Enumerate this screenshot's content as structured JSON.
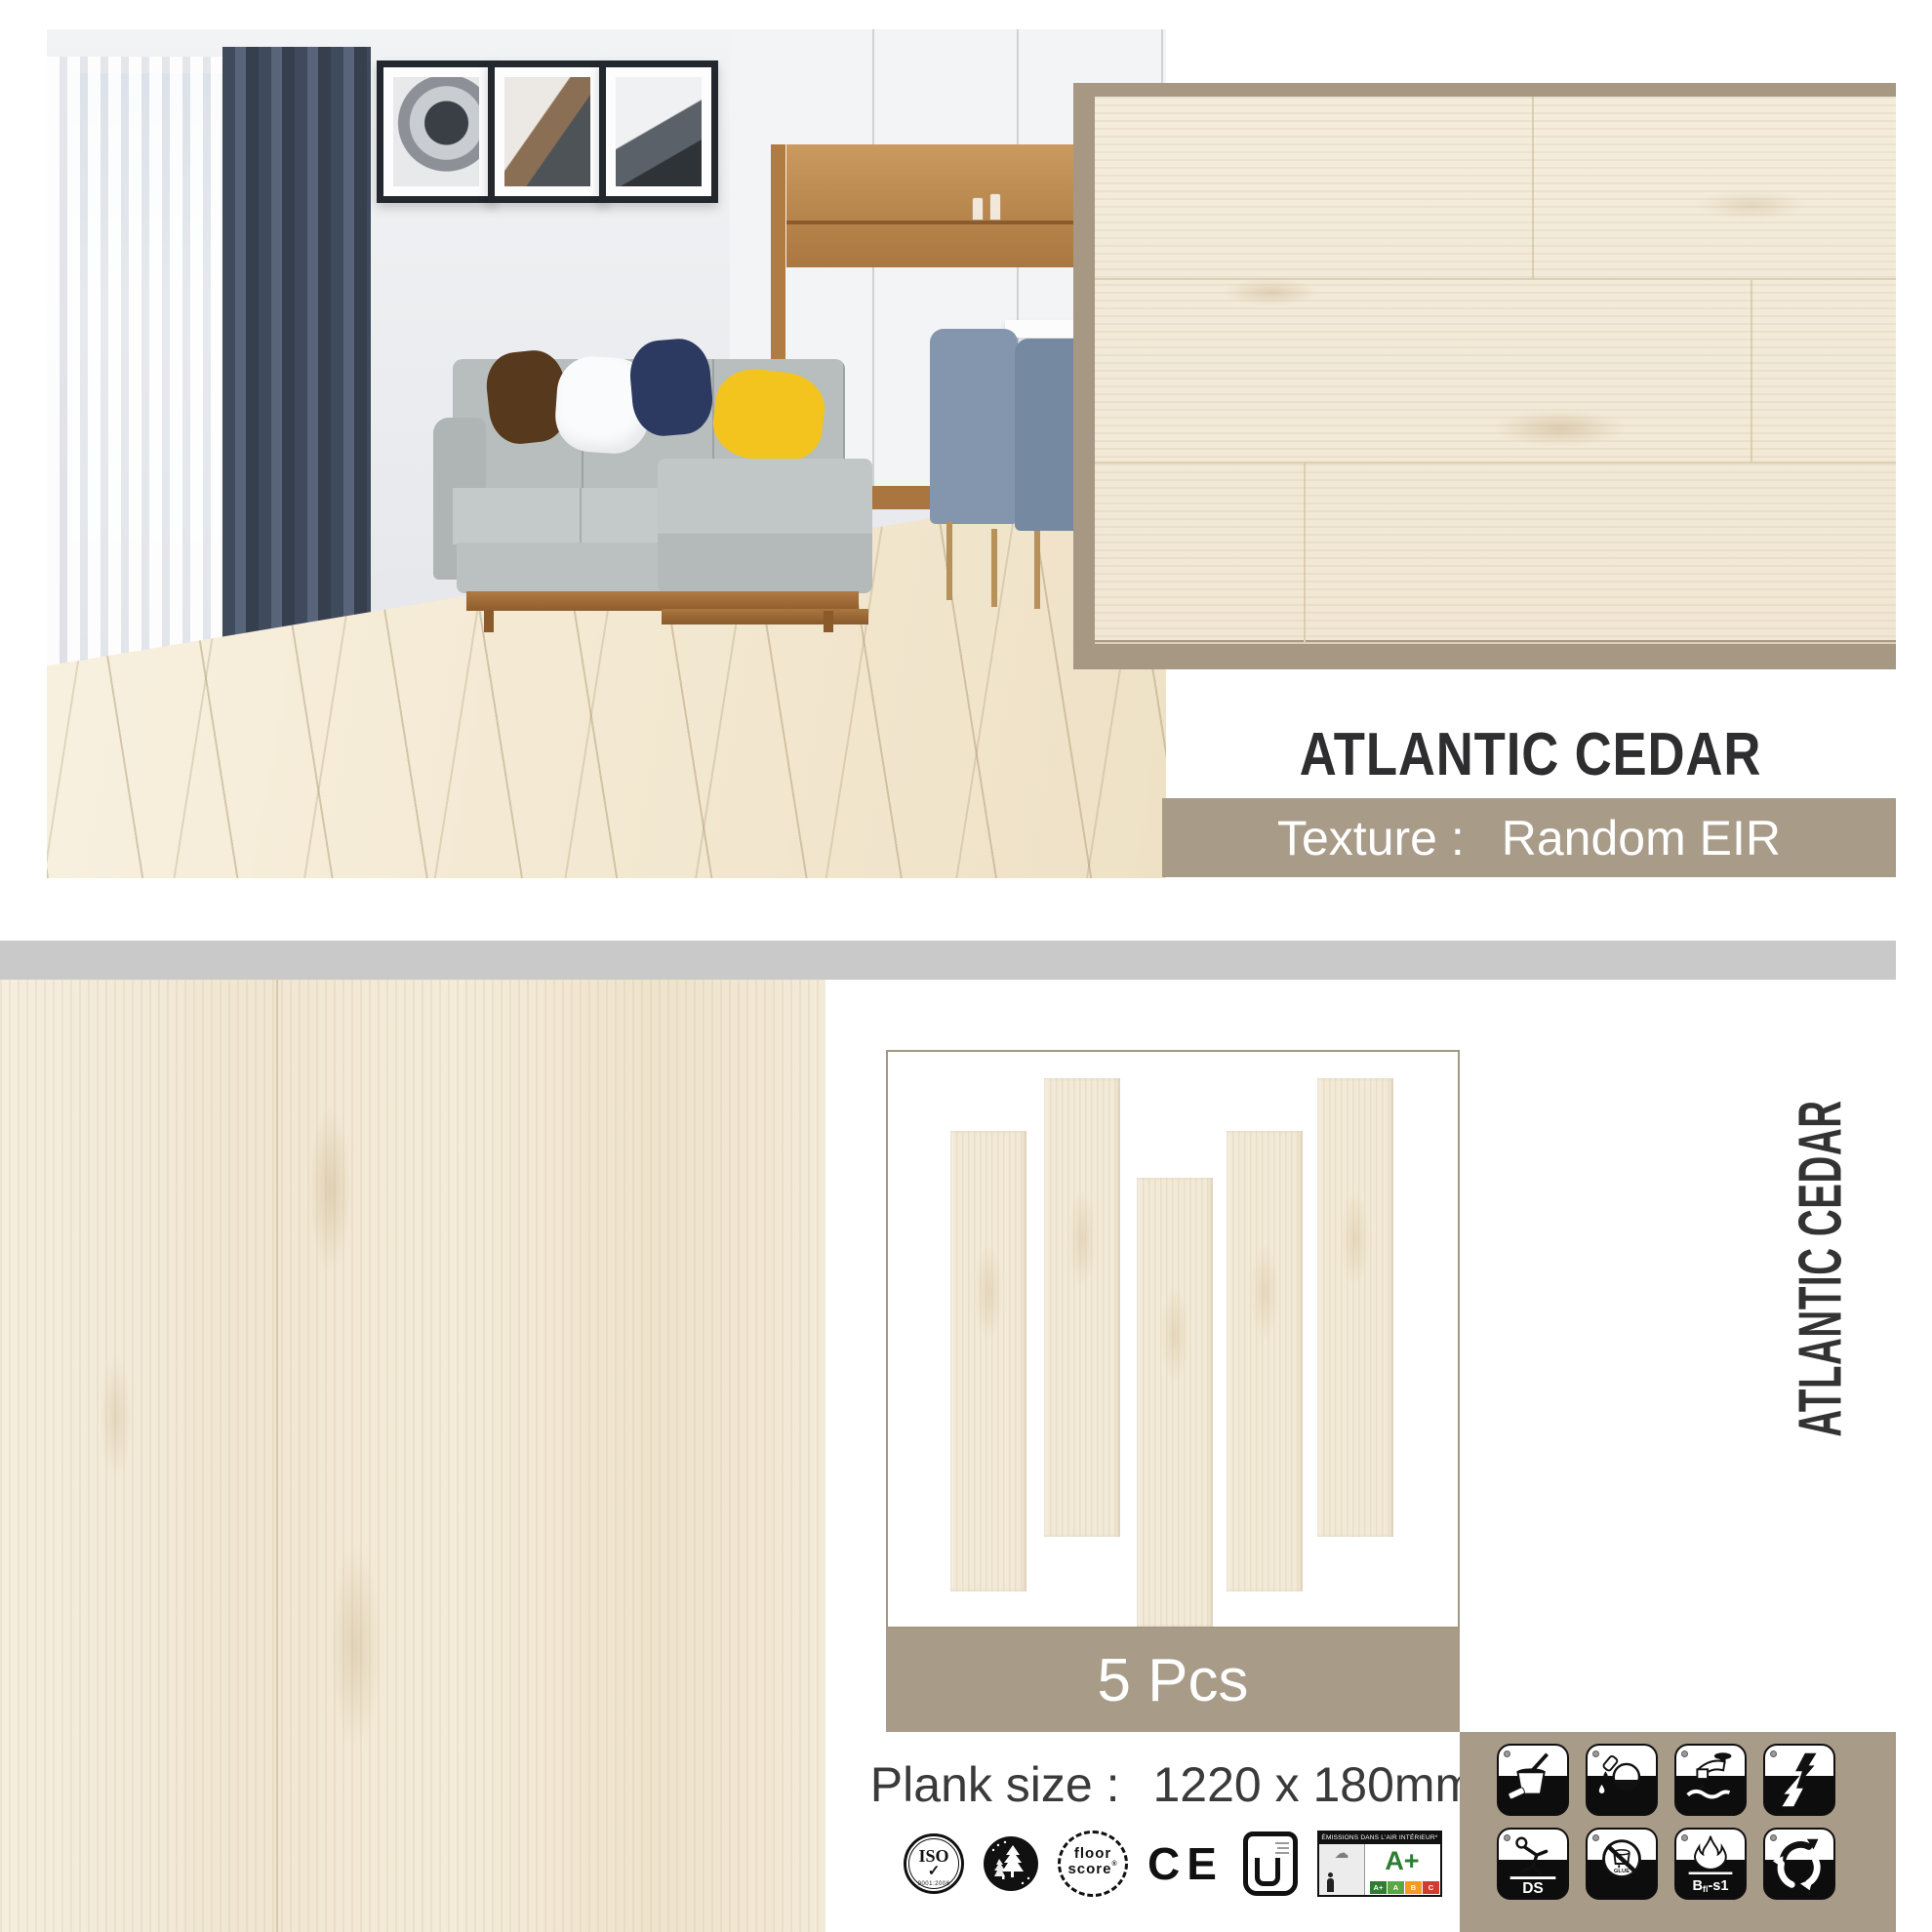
{
  "colors": {
    "tan": "#a89b88",
    "swatch_border": "#a69883",
    "divider_gray": "#c9c9c9",
    "title_dark": "#2e2e30",
    "aplus_green": "#2e7d32",
    "wood_cream": "#f2e9d6"
  },
  "swatch": {
    "title": "ATLANTIC CEDAR",
    "texture_label": "Texture :",
    "texture_value": "Random EIR"
  },
  "pack": {
    "pieces": "5 Pcs",
    "pieces_count": 5,
    "plank_size_label": "Plank size :",
    "plank_size_value": "1220 x 180mm"
  },
  "sidebar": {
    "vertical_title": "ATLANTIC CEDAR"
  },
  "certs": {
    "iso": {
      "label": "ISO",
      "check": "✓",
      "sub": "9001:2008"
    },
    "iso14000": {
      "name": "iso-14000-icon"
    },
    "floorscore": {
      "line1": "floor",
      "line2": "score",
      "reg": "®"
    },
    "ce": {
      "label": "CE"
    },
    "ul": {
      "name": "ul-mark-icon"
    },
    "emissions": {
      "header": "ÉMISSIONS DANS L'AIR INTÉRIEUR*",
      "grade": "A+",
      "scale": [
        "A+",
        "A",
        "B",
        "C"
      ]
    }
  },
  "features": {
    "names": [
      "easy-clean",
      "stain-resistant",
      "waterproof",
      "anti-static",
      "anti-slip",
      "glue-free",
      "fire-resistant",
      "recyclable"
    ],
    "slip_label": "DS",
    "glue_label": "GLUE",
    "fire_label_b": "B",
    "fire_label_sub": "fl",
    "fire_label_tail": "-s1"
  }
}
